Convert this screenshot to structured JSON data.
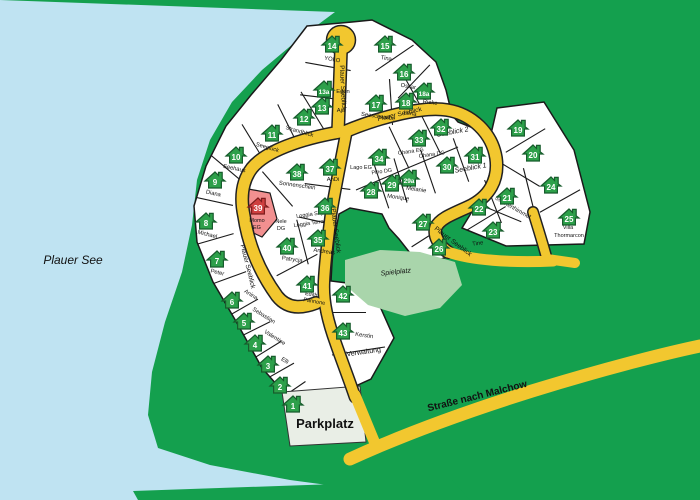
{
  "colors": {
    "land": "#14a04e",
    "water": "#bfe3f2",
    "road": "#f2c72f",
    "road_casing": "#222222",
    "plot_fill": "#ffffff",
    "plot_border": "#1a1a1a",
    "house_green": "#2da04a",
    "house_green_dark": "#175c2c",
    "house_red": "#cf4040",
    "house_red_dark": "#7c1d1d",
    "plot39_pink": "#f29090",
    "spielplatz": "#a9d5ab",
    "parkplatz": "#e9eee6",
    "label": "#111111"
  },
  "area_labels": [
    {
      "id": "lake",
      "text": "Plauer See",
      "x": 73,
      "y": 264,
      "size": 12,
      "italic": true,
      "bold": false,
      "rot": 0
    },
    {
      "id": "parking",
      "text": "Parkplatz",
      "x": 325,
      "y": 428,
      "size": 13,
      "italic": false,
      "bold": true,
      "rot": 0
    },
    {
      "id": "playground",
      "text": "Spielplatz",
      "x": 396,
      "y": 274,
      "size": 7,
      "italic": true,
      "bold": false,
      "rot": -6
    },
    {
      "id": "administration",
      "text": "Verwaltung",
      "x": 364,
      "y": 354,
      "size": 7,
      "italic": false,
      "bold": false,
      "rot": -8
    }
  ],
  "road_labels": [
    {
      "text": "Plauer Seeblick",
      "x": 341,
      "y": 88,
      "rot": 87,
      "size": 6.5
    },
    {
      "text": "Plauer Seeblick",
      "x": 400,
      "y": 116,
      "rot": -13,
      "size": 6.5
    },
    {
      "text": "Plauer Seeblick",
      "x": 246,
      "y": 267,
      "rot": 76,
      "size": 6.5
    },
    {
      "text": "Plauer Seeblick",
      "x": 334,
      "y": 231,
      "rot": 83,
      "size": 6.5
    },
    {
      "text": "Plauer Seeblick",
      "x": 452,
      "y": 243,
      "rot": 37,
      "size": 6.5
    },
    {
      "text": "Straße nach Malchow",
      "x": 478,
      "y": 399,
      "rot": -14,
      "size": 10,
      "bold": true
    }
  ],
  "plot_labels": [
    {
      "text": "Momo",
      "x": 257,
      "y": 222,
      "rot": 0,
      "size": 5.5
    },
    {
      "text": "EG",
      "x": 257,
      "y": 229,
      "rot": 0,
      "size": 5.5
    },
    {
      "text": "Nele",
      "x": 281,
      "y": 223,
      "rot": 0,
      "size": 5.5
    },
    {
      "text": "DG",
      "x": 281,
      "y": 230,
      "rot": 0,
      "size": 5.5
    },
    {
      "text": "Loggia Sky",
      "x": 310,
      "y": 216,
      "rot": -8,
      "size": 5.5
    },
    {
      "text": "Loggia Terra",
      "x": 309,
      "y": 225,
      "rot": -8,
      "size": 5.5
    },
    {
      "text": "Lago EG",
      "x": 361,
      "y": 169,
      "rot": 0,
      "size": 5.5
    },
    {
      "text": "Pino DG",
      "x": 382,
      "y": 173,
      "rot": -8,
      "size": 5.5
    },
    {
      "text": "Ohana EG",
      "x": 411,
      "y": 153,
      "rot": -8,
      "size": 5.5
    },
    {
      "text": "Ohana DG",
      "x": 432,
      "y": 156,
      "rot": -8,
      "size": 5.5
    },
    {
      "text": "Seeblick 2",
      "x": 453,
      "y": 134,
      "rot": -10,
      "size": 7,
      "italic": true
    },
    {
      "text": "Seeblick 1",
      "x": 471,
      "y": 170,
      "rot": -10,
      "size": 7,
      "italic": true
    },
    {
      "text": "Sternenhimmel",
      "x": 512,
      "y": 209,
      "rot": 30,
      "size": 6
    },
    {
      "text": "Edith",
      "x": 311,
      "y": 296,
      "rot": 10,
      "size": 5.5
    },
    {
      "text": "Pannone",
      "x": 314,
      "y": 303,
      "rot": 10,
      "size": 5.5
    },
    {
      "text": "Villa",
      "x": 568,
      "y": 229,
      "rot": 0,
      "size": 5.5
    },
    {
      "text": "Thormarcon",
      "x": 569,
      "y": 237,
      "rot": 0,
      "size": 5.5
    }
  ],
  "houses": [
    {
      "id": "1",
      "x": 293,
      "y": 404
    },
    {
      "id": "2",
      "x": 280,
      "y": 385
    },
    {
      "id": "3",
      "x": 268,
      "y": 364,
      "name": "Elli",
      "lx": 284,
      "ly": 362,
      "lrot": 32
    },
    {
      "id": "4",
      "x": 255,
      "y": 343,
      "name": "Valentine",
      "lx": 274,
      "ly": 339,
      "lrot": 32
    },
    {
      "id": "5",
      "x": 244,
      "y": 321,
      "name": "Sebastian",
      "lx": 263,
      "ly": 317,
      "lrot": 32
    },
    {
      "id": "6",
      "x": 232,
      "y": 300,
      "name": "Anina",
      "lx": 250,
      "ly": 296,
      "lrot": 32
    },
    {
      "id": "7",
      "x": 217,
      "y": 259,
      "name": "Peter",
      "lx": 217,
      "ly": 274,
      "lrot": 14
    },
    {
      "id": "8",
      "x": 206,
      "y": 221,
      "name": "Michael",
      "lx": 207,
      "ly": 236,
      "lrot": 14
    },
    {
      "id": "9",
      "x": 215,
      "y": 180,
      "name": "Diana",
      "lx": 213,
      "ly": 195,
      "lrot": 12
    },
    {
      "id": "10",
      "x": 236,
      "y": 155,
      "name": "Seehaus",
      "lx": 234,
      "ly": 170,
      "lrot": 12
    },
    {
      "id": "11",
      "x": 272,
      "y": 133,
      "name": "Seeglück",
      "lx": 267,
      "ly": 149,
      "lrot": 16
    },
    {
      "id": "12",
      "x": 304,
      "y": 117,
      "name": "Strandblick",
      "lx": 299,
      "ly": 133,
      "lrot": 16
    },
    {
      "id": "13",
      "x": 322,
      "y": 106,
      "name": "Aja",
      "lx": 341,
      "ly": 112,
      "lrot": 0
    },
    {
      "id": "13a",
      "x": 324,
      "y": 89,
      "name": "Egon",
      "lx": 343,
      "ly": 93,
      "lrot": 0
    },
    {
      "id": "14",
      "x": 332,
      "y": 44,
      "name": "YOLO",
      "lx": 332,
      "ly": 61,
      "lrot": 10
    },
    {
      "id": "15",
      "x": 385,
      "y": 44,
      "name": "Tina",
      "lx": 386,
      "ly": 60,
      "lrot": 10
    },
    {
      "id": "16",
      "x": 404,
      "y": 72,
      "name": "Oskar",
      "lx": 408,
      "ly": 88,
      "lrot": 10
    },
    {
      "id": "17",
      "x": 376,
      "y": 103,
      "name": "Seeschwalbe",
      "lx": 378,
      "ly": 118,
      "lrot": 8
    },
    {
      "id": "18",
      "x": 406,
      "y": 101,
      "name": "Lena",
      "lx": 410,
      "ly": 115,
      "lrot": 8
    },
    {
      "id": "18a",
      "x": 424,
      "y": 91,
      "name": "Rieke",
      "lx": 430,
      "ly": 104,
      "lrot": 8
    },
    {
      "id": "19",
      "x": 518,
      "y": 128
    },
    {
      "id": "20",
      "x": 533,
      "y": 153
    },
    {
      "id": "21",
      "x": 507,
      "y": 196
    },
    {
      "id": "22",
      "x": 479,
      "y": 207
    },
    {
      "id": "23",
      "x": 493,
      "y": 230,
      "name": "Tine",
      "lx": 478,
      "ly": 245,
      "lrot": -8
    },
    {
      "id": "24",
      "x": 551,
      "y": 185
    },
    {
      "id": "25",
      "x": 569,
      "y": 217
    },
    {
      "id": "26",
      "x": 439,
      "y": 247
    },
    {
      "id": "27",
      "x": 423,
      "y": 222
    },
    {
      "id": "28",
      "x": 371,
      "y": 190
    },
    {
      "id": "29",
      "x": 392,
      "y": 183,
      "name": "Monique",
      "lx": 398,
      "ly": 199,
      "lrot": 8
    },
    {
      "id": "29a",
      "x": 409,
      "y": 178,
      "name": "Melanie",
      "lx": 416,
      "ly": 191,
      "lrot": 8
    },
    {
      "id": "30",
      "x": 447,
      "y": 165
    },
    {
      "id": "31",
      "x": 475,
      "y": 155
    },
    {
      "id": "32",
      "x": 441,
      "y": 127
    },
    {
      "id": "33",
      "x": 419,
      "y": 138
    },
    {
      "id": "34",
      "x": 379,
      "y": 157
    },
    {
      "id": "35",
      "x": 318,
      "y": 238,
      "name": "Andreas",
      "lx": 324,
      "ly": 253,
      "lrot": 8
    },
    {
      "id": "36",
      "x": 325,
      "y": 206
    },
    {
      "id": "37",
      "x": 330,
      "y": 167,
      "name": "AnDi",
      "lx": 333,
      "ly": 181,
      "lrot": 0
    },
    {
      "id": "38",
      "x": 297,
      "y": 172,
      "name": "Sonnenschein",
      "lx": 297,
      "ly": 187,
      "lrot": 8
    },
    {
      "id": "39",
      "x": 258,
      "y": 206,
      "red": true
    },
    {
      "id": "40",
      "x": 287,
      "y": 246,
      "name": "Patrycja",
      "lx": 292,
      "ly": 261,
      "lrot": 8
    },
    {
      "id": "41",
      "x": 307,
      "y": 284
    },
    {
      "id": "42",
      "x": 343,
      "y": 294
    },
    {
      "id": "43",
      "x": 343,
      "y": 331,
      "name": "Kerstin",
      "lx": 364,
      "ly": 337,
      "lrot": 8
    }
  ]
}
